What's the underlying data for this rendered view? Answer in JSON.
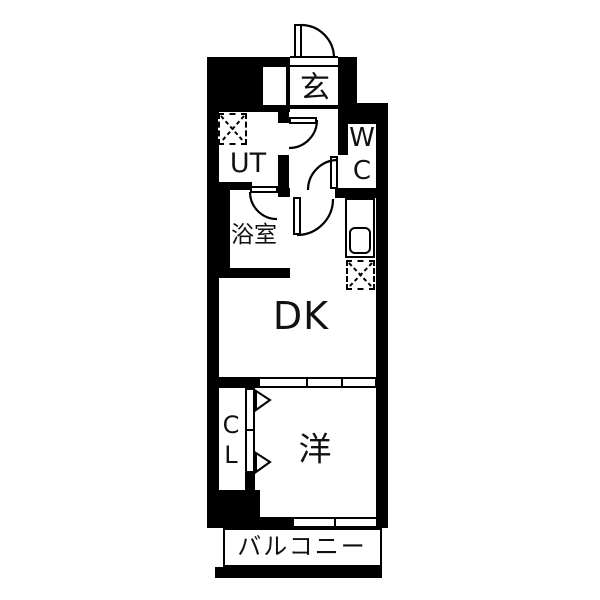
{
  "title": "apartment-floor-plan",
  "colors": {
    "wall": "#000000",
    "background": "#ffffff",
    "text": "#111111"
  },
  "rooms": {
    "genkan": {
      "label": "玄"
    },
    "utility": {
      "label": "UT"
    },
    "toilet": {
      "label": "WC",
      "line1": "W",
      "line2": "C"
    },
    "bathroom": {
      "label": "浴室"
    },
    "dining_kitchen": {
      "label": "DK"
    },
    "closet": {
      "label": "CL",
      "line1": "C",
      "line2": "L"
    },
    "western_room": {
      "label": "洋"
    },
    "balcony": {
      "label": "バルコニー"
    }
  },
  "fixtures": {
    "washer_pan": "washing-machine-pan-dashed-square",
    "refrigerator": "refrigerator-space-dashed-square",
    "kitchen_sink": "kitchen-counter-with-sink",
    "entrance_door": "swing-door-arc",
    "interior_doors": "swing-door-arcs",
    "closet_door": "folding-door-triangles",
    "partitions": "sliding-door-bands"
  }
}
